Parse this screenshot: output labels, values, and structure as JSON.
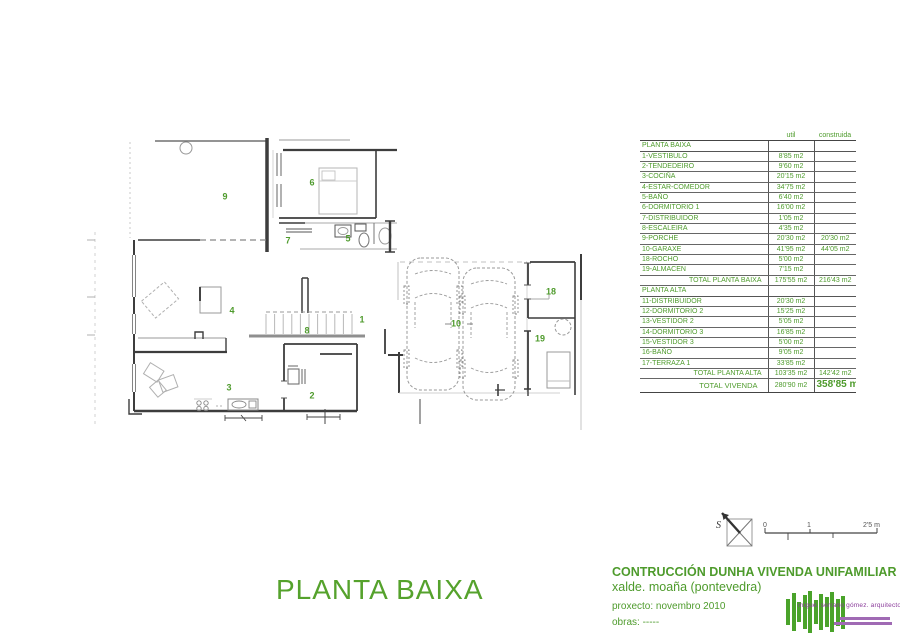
{
  "sheet": {
    "title": "PLANTA BAIXA",
    "north_label": "S",
    "scale_bar": {
      "labels": [
        "0",
        "1",
        "2'5 m"
      ]
    },
    "title_block": {
      "line1": "CONTRUCCIÓN DUNHA VIVENDA UNIFAMILIAR",
      "line2": "xalde. moaña (pontevedra)",
      "proxecto": "proxecto: novembro 2010",
      "obras": "obras: -----"
    },
    "logo": {
      "architect": "migue. serrano gómez. arquitecto"
    }
  },
  "areas_table": {
    "headers": {
      "util": "util",
      "construida": "construida"
    },
    "sections": [
      {
        "header": "PLANTA BAIXA",
        "rows": [
          [
            "1-VESTIBULO",
            "8'85 m2",
            ""
          ],
          [
            "2-TENDEDEIRO",
            "9'60 m2",
            ""
          ],
          [
            "3-COCIÑA",
            "20'15 m2",
            ""
          ],
          [
            "4-ESTAR-COMEDOR",
            "34'75 m2",
            ""
          ],
          [
            "5-BAÑO",
            "6'40 m2",
            ""
          ],
          [
            "6-DORMITORIO 1",
            "16'00 m2",
            ""
          ],
          [
            "7-DISTRIBUIDOR",
            "1'05 m2",
            ""
          ],
          [
            "8-ESCALEIRA",
            "4'35 m2",
            ""
          ],
          [
            "9-PORCHE",
            "20'30 m2",
            "20'30 m2"
          ],
          [
            "10-GARAXE",
            "41'95 m2",
            "44'05 m2"
          ],
          [
            "18-ROCHO",
            "5'00 m2",
            ""
          ],
          [
            "19-ALMACEN",
            "7'15 m2",
            ""
          ]
        ],
        "total": {
          "label": "TOTAL  PLANTA BAIXA",
          "util": "175'55 m2",
          "construida": "216'43 m2"
        }
      },
      {
        "header": "PLANTA ALTA",
        "rows": [
          [
            "11-DISTRIBUIDOR",
            "20'30 m2",
            ""
          ],
          [
            "12-DORMITORIO 2",
            "15'25 m2",
            ""
          ],
          [
            "13-VESTIDOR 2",
            "5'05 m2",
            ""
          ],
          [
            "14-DORMITORIO 3",
            "16'85 m2",
            ""
          ],
          [
            "15-VESTIDOR 3",
            "5'00 m2",
            ""
          ],
          [
            "16-BAÑO",
            "9'05 m2",
            ""
          ],
          [
            "17-TERRAZA 1",
            "33'85 m2",
            ""
          ]
        ],
        "total": {
          "label": "TOTAL  PLANTA ALTA",
          "util": "103'35 m2",
          "construida": "142'42 m2"
        }
      }
    ],
    "grand_total": {
      "label": "TOTAL VIVENDA",
      "util": "280'90 m2",
      "construida": "358'85 m2"
    }
  },
  "plan": {
    "rooms": [
      {
        "label": "9",
        "x": 225,
        "y": 197
      },
      {
        "label": "6",
        "x": 312,
        "y": 183
      },
      {
        "label": "7",
        "x": 288,
        "y": 241
      },
      {
        "label": "5",
        "x": 348,
        "y": 239
      },
      {
        "label": "4",
        "x": 232,
        "y": 311
      },
      {
        "label": "8",
        "x": 307,
        "y": 331
      },
      {
        "label": "1",
        "x": 362,
        "y": 320
      },
      {
        "label": "3",
        "x": 229,
        "y": 388
      },
      {
        "label": "2",
        "x": 312,
        "y": 396
      },
      {
        "label": "10",
        "x": 456,
        "y": 324
      },
      {
        "label": "18",
        "x": 551,
        "y": 292
      },
      {
        "label": "19",
        "x": 540,
        "y": 339
      }
    ]
  }
}
